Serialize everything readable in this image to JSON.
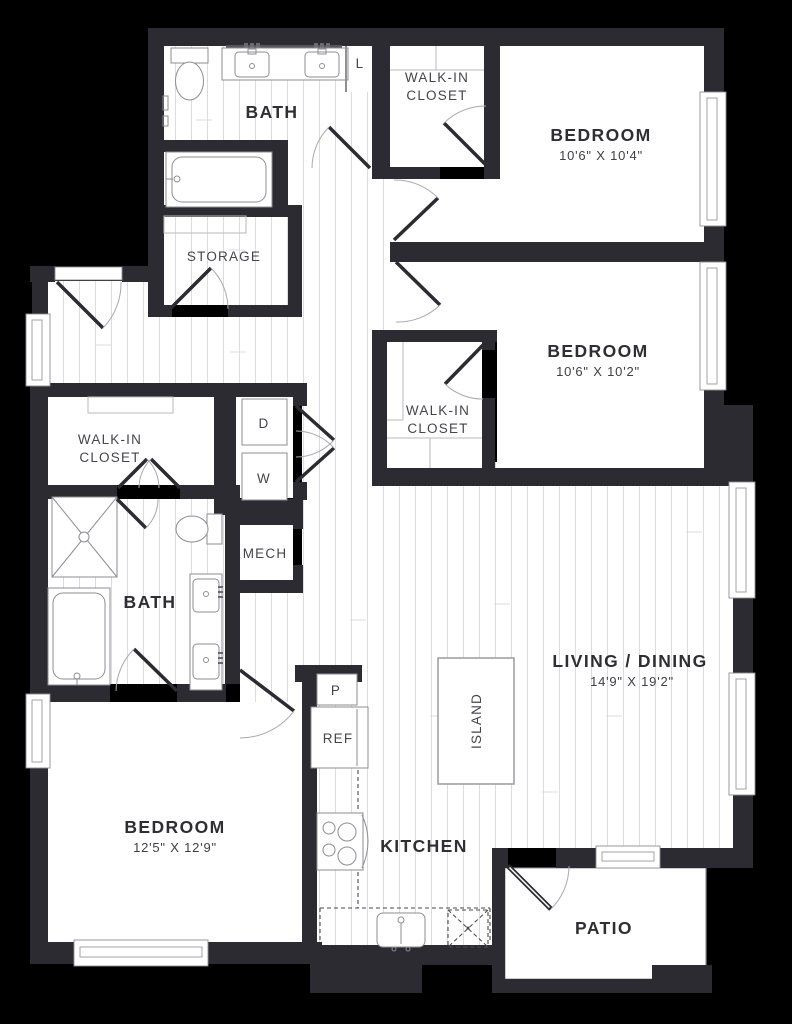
{
  "colors": {
    "background": "#000000",
    "wall": "#2b2b31",
    "floor": "#ffffff",
    "plank_line": "#dcdce0",
    "fixture_outline": "#8d8d93",
    "label_bold": "#2e2e33",
    "label_regular": "#45454b"
  },
  "rooms": {
    "bath_top": {
      "name": "BATH"
    },
    "linen": {
      "name": "L"
    },
    "wic_top": {
      "line1": "WALK-IN",
      "line2": "CLOSET"
    },
    "bedroom1": {
      "name": "BEDROOM",
      "dims": "10'6\" X 10'4\""
    },
    "storage": {
      "name": "STORAGE"
    },
    "bedroom2": {
      "name": "BEDROOM",
      "dims": "10'6\" X 10'2\""
    },
    "wic_mid": {
      "line1": "WALK-IN",
      "line2": "CLOSET"
    },
    "wic_left": {
      "line1": "WALK-IN",
      "line2": "CLOSET"
    },
    "laundry": {
      "dryer": "D",
      "washer": "W"
    },
    "mech": {
      "name": "MECH"
    },
    "bath_lower": {
      "name": "BATH"
    },
    "bedroom3": {
      "name": "BEDROOM",
      "dims": "12'5\" X 12'9\""
    },
    "kitchen": {
      "name": "KITCHEN",
      "pantry": "P",
      "fridge": "REF",
      "island": "ISLAND"
    },
    "living": {
      "name": "LIVING / DINING",
      "dims": "14'9\" X 19'2\""
    },
    "patio": {
      "name": "PATIO"
    }
  },
  "fixtures": [
    "toilet",
    "sink",
    "bathtub",
    "shower",
    "washer",
    "dryer",
    "refrigerator",
    "range",
    "kitchen-sink",
    "dishwasher",
    "kitchen-island",
    "window",
    "door"
  ]
}
